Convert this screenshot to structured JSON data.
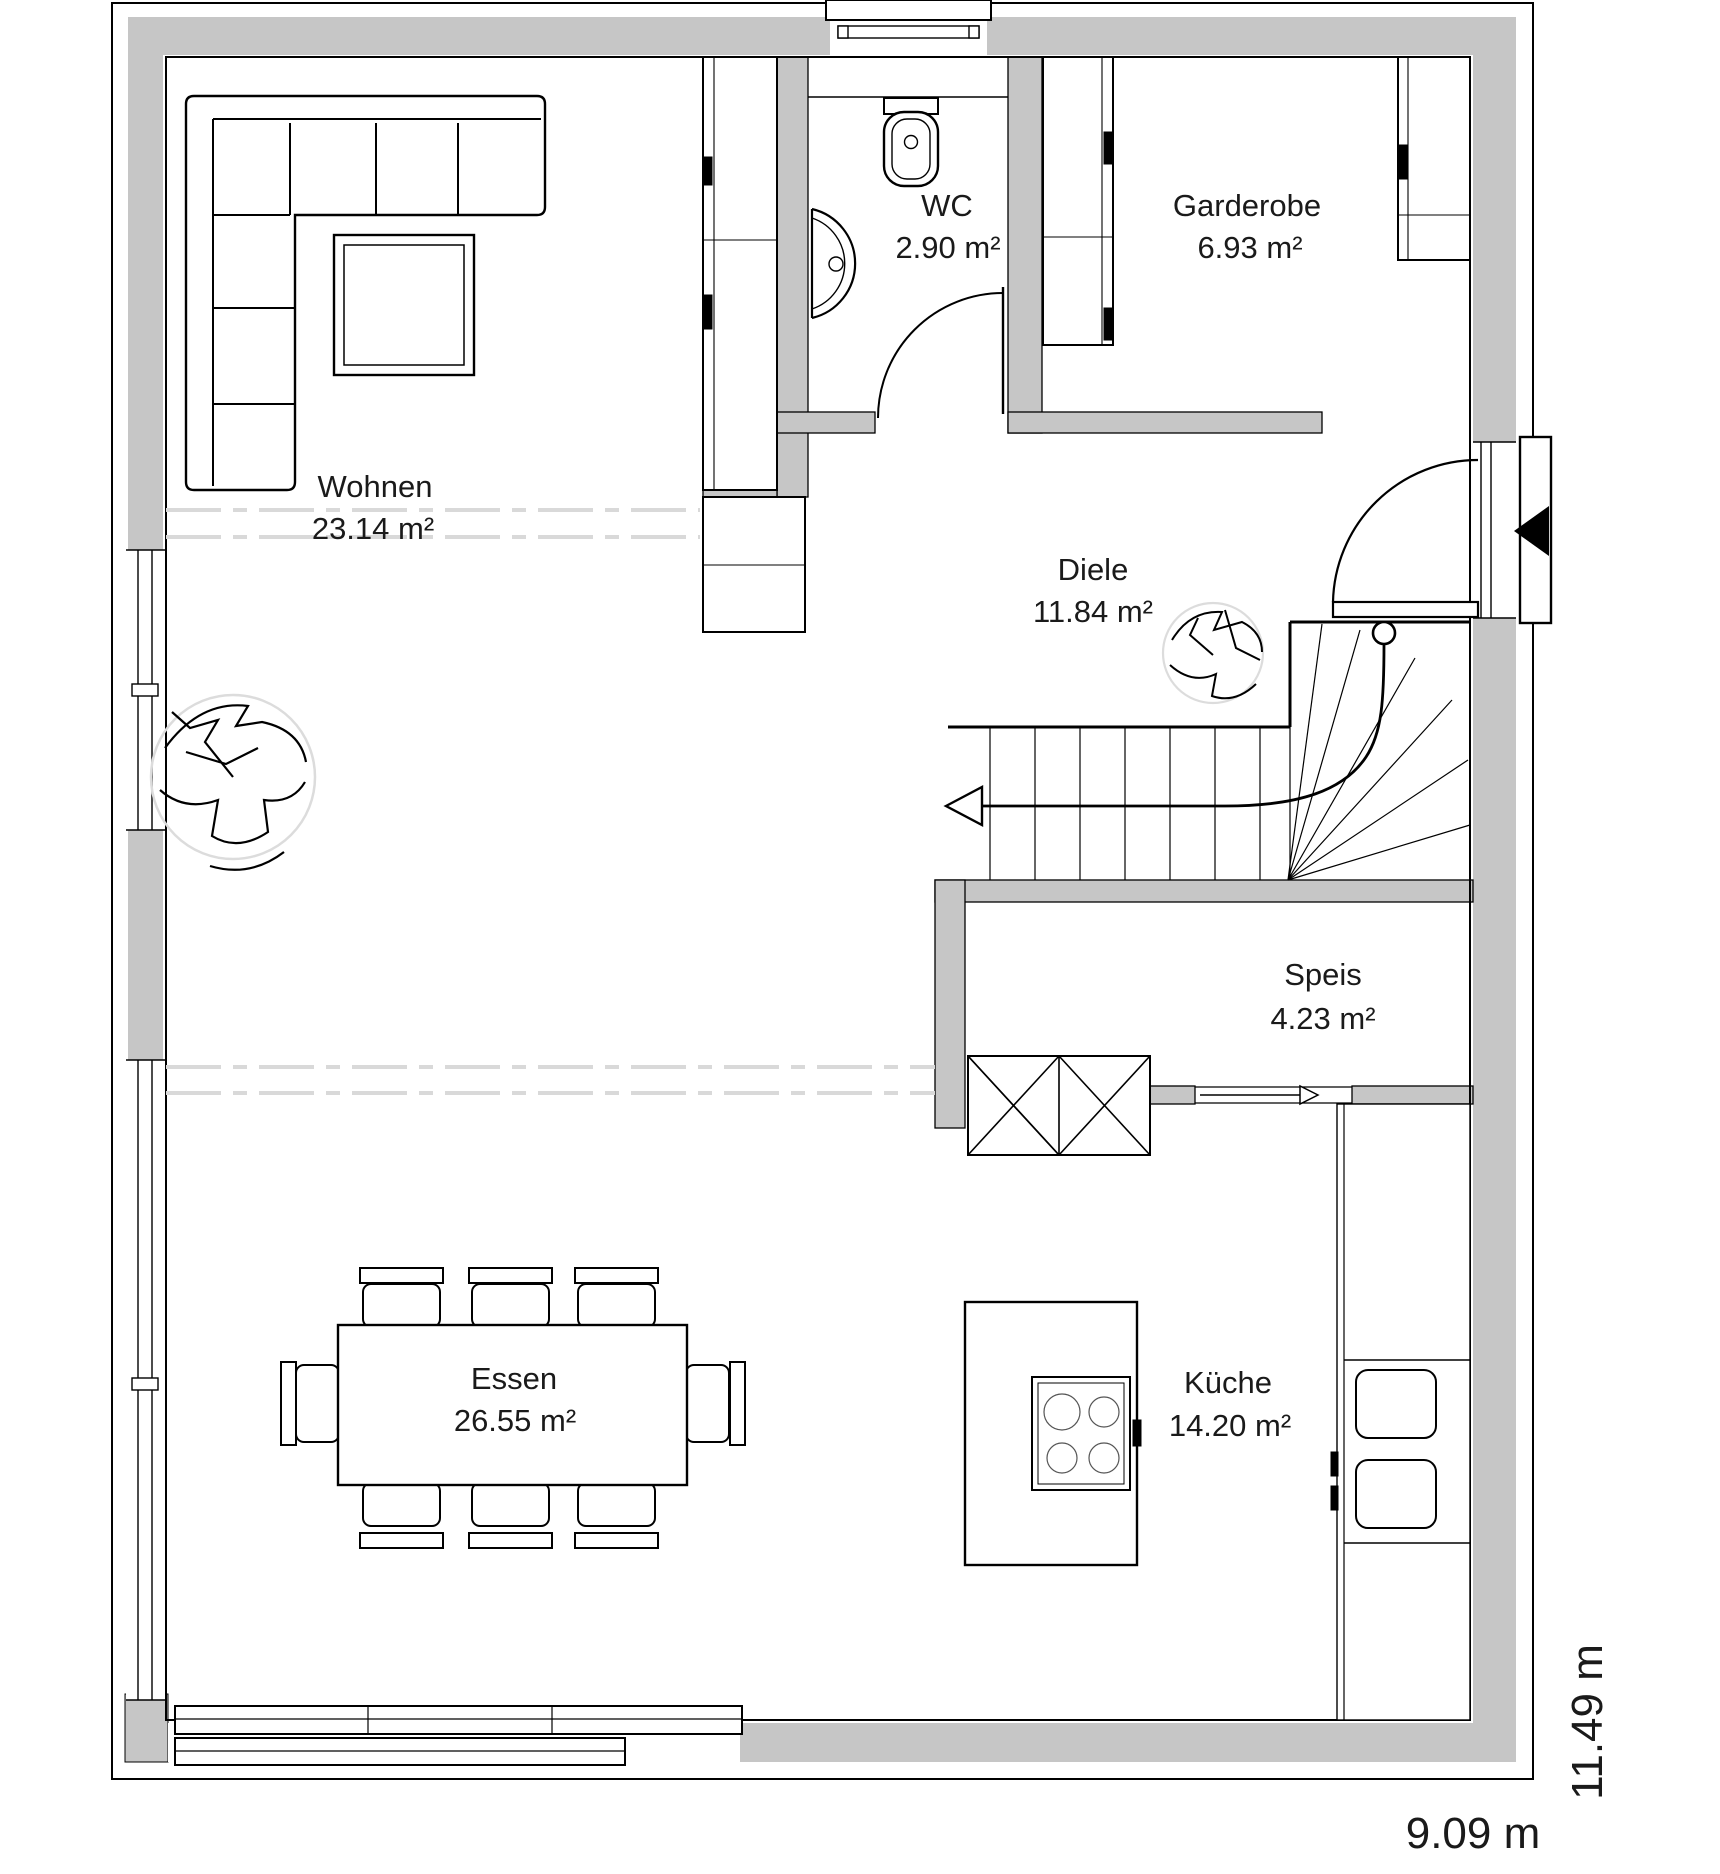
{
  "rooms": [
    {
      "id": "wohnen",
      "name": "Wohnen",
      "area": "23.14 m²"
    },
    {
      "id": "wc",
      "name": "WC",
      "area": "2.90 m²"
    },
    {
      "id": "garderobe",
      "name": "Garderobe",
      "area": "6.93 m²"
    },
    {
      "id": "diele",
      "name": "Diele",
      "area": "11.84 m²"
    },
    {
      "id": "speis",
      "name": "Speis",
      "area": "4.23 m²"
    },
    {
      "id": "essen",
      "name": "Essen",
      "area": "26.55 m²"
    },
    {
      "id": "kueche",
      "name": "Küche",
      "area": "14.20 m²"
    }
  ],
  "dimensions": {
    "width": "9.09 m",
    "height": "11.49 m"
  },
  "colors": {
    "wall": "#c6c6c6",
    "line": "#000000",
    "dash": "#d9d9d9",
    "plant_ring": "#dcdcdc",
    "background": "#ffffff"
  }
}
